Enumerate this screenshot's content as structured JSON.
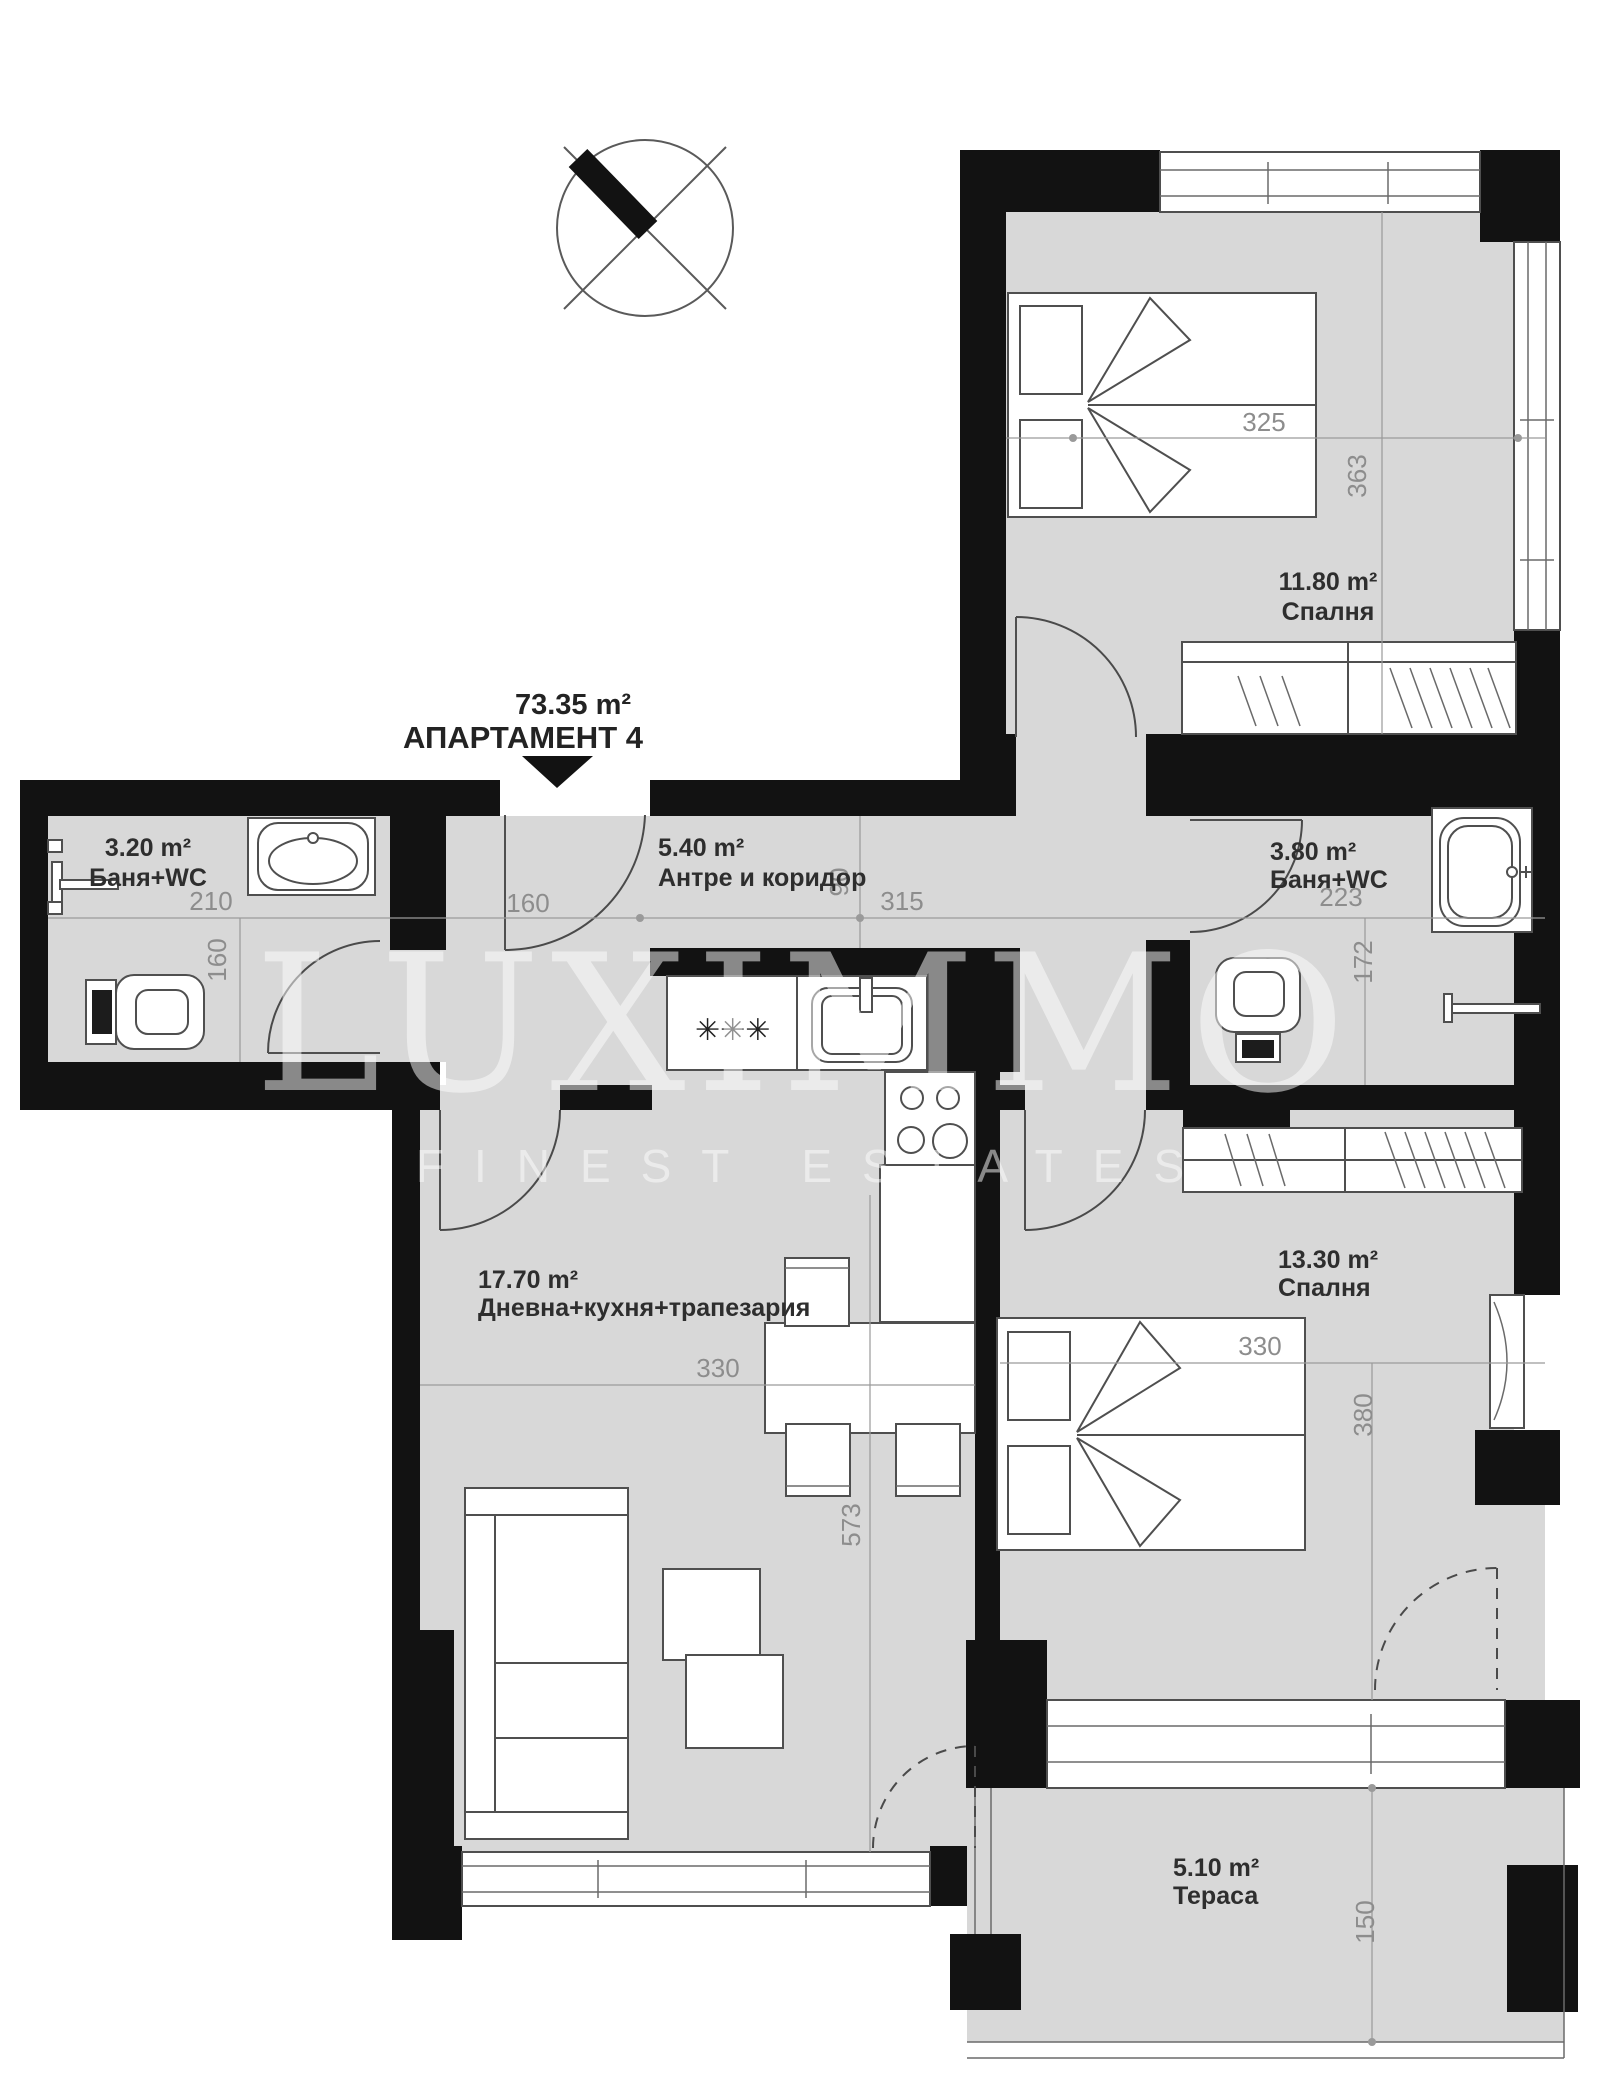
{
  "header": {
    "area_total": "73.35 m²",
    "apartment": "АПАРТАМЕНТ 4"
  },
  "watermark": {
    "brand": "LUXIMMO",
    "tagline": "FINEST ESTATES"
  },
  "rooms": {
    "bedroom1": {
      "area": "11.80 m²",
      "name": "Спалня"
    },
    "bath1": {
      "area": "3.20 m²",
      "name": "Баня+WC"
    },
    "hall": {
      "area": "5.40 m²",
      "name": "Антре и коридор"
    },
    "bath2": {
      "area": "3.80 m²",
      "name": "Баня+WC"
    },
    "living": {
      "area": "17.70 m²",
      "name": "Дневна+кухня+трапезария"
    },
    "bedroom2": {
      "area": "13.30 m²",
      "name": "Спалня"
    },
    "terrace": {
      "area": "5.10 m²",
      "name": "Тераса"
    }
  },
  "dimensions": {
    "bedroom1_w": "325",
    "bedroom1_h": "363",
    "bath1_w": "210",
    "bath1_h": "160",
    "hall_nook": "160",
    "hall_w": "315",
    "hall_d": "90",
    "bath2_w": "223",
    "bath2_h": "172",
    "living_w": "330",
    "living_h": "573",
    "bedroom2_w": "330",
    "bedroom2_h": "380",
    "terrace_d": "150"
  },
  "kitchen": {
    "hob_mark": "✳✳✳"
  },
  "colors": {
    "wall": "#121212",
    "floor": "#d8d8d8",
    "dim_text": "#8d8d8d"
  }
}
